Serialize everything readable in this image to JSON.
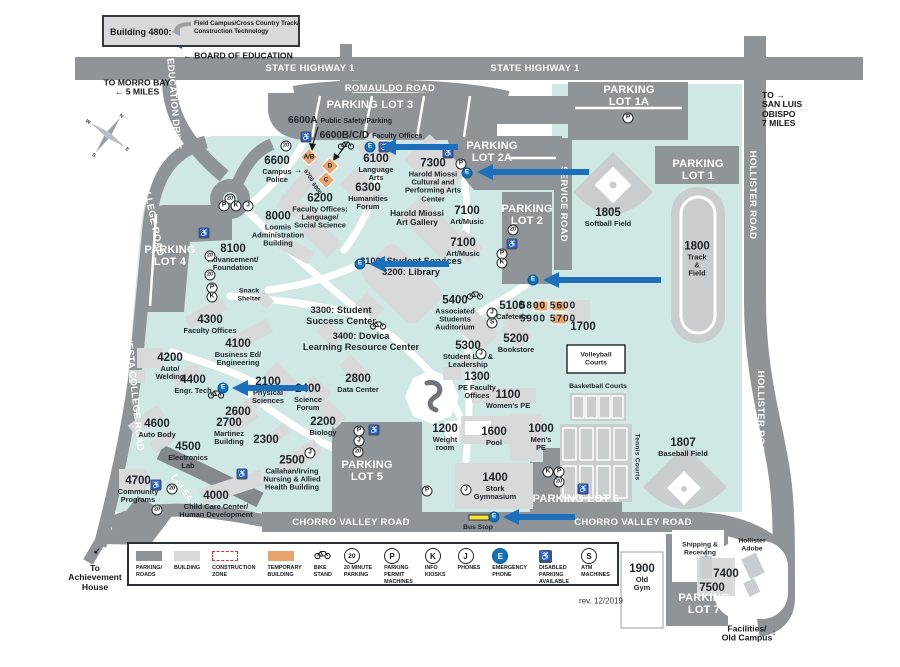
{
  "colors": {
    "campus": "#cfe8e5",
    "road": "#8f9499",
    "building": "#d7d9da",
    "field": "#c9cdd0",
    "temporary": "#e9a46c",
    "emergency_blue": "#1273bc",
    "arrow_blue": "#1b6fbd",
    "construction_red": "#e02f22",
    "bus_stop_yellow": "#f3e13c",
    "text_dark": "#15181c",
    "text_white": "#ffffff"
  },
  "callout": {
    "title": "Building 4800:",
    "text": "Field Campus/Cross Country Track/\nConstruction Technology"
  },
  "compass": [
    "N",
    "E",
    "S",
    "W"
  ],
  "road_labels": [
    {
      "t": "STATE HIGHWAY 1",
      "x": 310,
      "y": 69
    },
    {
      "t": "STATE HIGHWAY 1",
      "x": 535,
      "y": 69
    },
    {
      "t": "ROMAULDO ROAD",
      "x": 390,
      "y": 89
    },
    {
      "t": "CHORRO VALLEY ROAD",
      "x": 351,
      "y": 523
    },
    {
      "t": "CHORRO VALLEY ROAD",
      "x": 633,
      "y": 523
    },
    {
      "t": "EDUCATION DRIVE",
      "x": 173,
      "y": 104,
      "r": 85
    },
    {
      "t": "CUESTA COLLEGE ROAD",
      "x": 147,
      "y": 196,
      "r": 78
    },
    {
      "t": "CUESTA COLLEGE ROAD",
      "x": 133,
      "y": 390,
      "r": 84
    },
    {
      "t": "HOLLISTER ROAD",
      "x": 752,
      "y": 195,
      "r": 90
    },
    {
      "t": "HOLLISTER ROAD",
      "x": 760,
      "y": 415,
      "r": 90
    },
    {
      "t": "SERVICE ROAD",
      "x": 563,
      "y": 204,
      "r": 90
    },
    {
      "t": "Lot 5A",
      "x": 181,
      "y": 489,
      "r": 55
    },
    {
      "t": "Tennis Courts",
      "x": 637,
      "y": 457,
      "r": 90,
      "dark": true
    }
  ],
  "lot_labels": [
    {
      "t": "PARKING LOT 3",
      "x": 370,
      "y": 106
    },
    {
      "t": "PARKING\nLOT 1A",
      "x": 629,
      "y": 97
    },
    {
      "t": "PARKING\nLOT 2A",
      "x": 492,
      "y": 153
    },
    {
      "t": "PARKING\nLOT 1",
      "x": 698,
      "y": 171
    },
    {
      "t": "PARKING\nLOT 2",
      "x": 527,
      "y": 216
    },
    {
      "t": "PARKING\nLOT 4",
      "x": 170,
      "y": 257
    },
    {
      "t": "PARKING\nLOT 5",
      "x": 367,
      "y": 472
    },
    {
      "t": "PARKING LOT 6",
      "x": 576,
      "y": 500
    },
    {
      "t": "PARKING\nLOT 7",
      "x": 704,
      "y": 605
    }
  ],
  "buildings": [
    {
      "num": "6600A",
      "name": "Public Safety/Parking",
      "x": 340,
      "y": 119,
      "s": "inl"
    },
    {
      "num": "6600B/C/D",
      "name": "Faculty Offices",
      "x": 371,
      "y": 134,
      "s": "inl"
    },
    {
      "num": "6600",
      "name": "Campus\nPolice",
      "x": 277,
      "y": 170
    },
    {
      "num": "6100",
      "name": "Language\nArts",
      "x": 376,
      "y": 168
    },
    {
      "num": "7300",
      "name": "Harold Miossi\nCultural and\nPerforming Arts\nCenter",
      "x": 433,
      "y": 181
    },
    {
      "num": "6300",
      "name": "Humanities\nForum",
      "x": 368,
      "y": 197
    },
    {
      "num": "6200",
      "name": "Faculty Offices:\nLanguage/\nSocial Science",
      "x": 320,
      "y": 212
    },
    {
      "name": "Harold Miossi\nArt Gallery",
      "x": 417,
      "y": 218,
      "s": "md"
    },
    {
      "num": "7100",
      "name": "Art/Music",
      "x": 467,
      "y": 216
    },
    {
      "num": "7100",
      "name": "Art/Music",
      "x": 463,
      "y": 248
    },
    {
      "num": "8000",
      "name": "Loomis\nAdministration\nBuilding",
      "x": 278,
      "y": 230
    },
    {
      "num": "8100",
      "name": "Advancement/\nFoundation",
      "x": 233,
      "y": 258
    },
    {
      "name": "Snack\nShelter",
      "x": 249,
      "y": 295,
      "s": "sm"
    },
    {
      "name": "3100: Student Services\n3200: Library",
      "x": 411,
      "y": 267,
      "s": "lg"
    },
    {
      "name": "3300: Student\nSuccess Center",
      "x": 341,
      "y": 316,
      "s": "lg"
    },
    {
      "name": "3400: Dovica\nLearning Resource Center",
      "x": 361,
      "y": 342,
      "s": "lg"
    },
    {
      "num": "5400",
      "name": "Associated\nStudents\nAuditorium",
      "x": 455,
      "y": 314
    },
    {
      "num": "5100",
      "name": "Cafeteria",
      "x": 512,
      "y": 311
    },
    {
      "name": "5800 5600",
      "x": 548,
      "y": 306,
      "s": "num2"
    },
    {
      "name": "5900 5700",
      "x": 548,
      "y": 319,
      "s": "num2"
    },
    {
      "num": "1700",
      "x": 583,
      "y": 328
    },
    {
      "num": "5200",
      "name": "Bookstore",
      "x": 516,
      "y": 344
    },
    {
      "num": "5300",
      "name": "Student Life &\nLeadership",
      "x": 468,
      "y": 355
    },
    {
      "num": "4300",
      "name": "Faculty Offices",
      "x": 210,
      "y": 325
    },
    {
      "num": "4100",
      "name": "Business Ed/\nEngineering",
      "x": 238,
      "y": 353
    },
    {
      "num": "4200",
      "name": "Auto/\nWelding",
      "x": 170,
      "y": 367
    },
    {
      "num": "4400",
      "name": "Engr. Tech",
      "x": 193,
      "y": 385
    },
    {
      "num": "2100",
      "name": "Physical\nSciences",
      "x": 268,
      "y": 391
    },
    {
      "num": "2400",
      "name": "Science\nForum",
      "x": 308,
      "y": 398
    },
    {
      "num": "2800",
      "name": "Data Center",
      "x": 358,
      "y": 384
    },
    {
      "num": "2600",
      "x": 238,
      "y": 413
    },
    {
      "num": "2700",
      "name": "Martinez\nBuilding",
      "x": 229,
      "y": 432
    },
    {
      "num": "2300",
      "x": 266,
      "y": 441
    },
    {
      "num": "2200",
      "name": "Biology",
      "x": 323,
      "y": 427
    },
    {
      "num": "4600",
      "name": "Auto Body",
      "x": 157,
      "y": 429
    },
    {
      "num": "4500",
      "name": "Electronics\nLab",
      "x": 188,
      "y": 456
    },
    {
      "num": "2500",
      "name": "Callahan/Irving\nNursing & Allied\nHealth Building",
      "x": 292,
      "y": 474
    },
    {
      "num": "4700",
      "name": "Community\nPrograms",
      "x": 138,
      "y": 490
    },
    {
      "num": "4000",
      "name": "Child Care Center/\nHuman Development",
      "x": 216,
      "y": 505
    },
    {
      "num": "1300",
      "name": "PE Faculty\nOffices",
      "x": 477,
      "y": 386
    },
    {
      "num": "1100",
      "name": "Women's PE",
      "x": 508,
      "y": 400
    },
    {
      "num": "1200",
      "name": "Weight\nroom",
      "x": 445,
      "y": 438
    },
    {
      "num": "1600",
      "name": "Pool",
      "x": 494,
      "y": 437
    },
    {
      "num": "1000",
      "name": "Men's\nPE",
      "x": 541,
      "y": 438
    },
    {
      "num": "1400",
      "name": "Stork\nGymnasium",
      "x": 495,
      "y": 487
    },
    {
      "name": "Bus Stop",
      "x": 478,
      "y": 528,
      "s": "sm"
    },
    {
      "num": "1805",
      "name": "Softball Field",
      "x": 608,
      "y": 218
    },
    {
      "num": "1800",
      "name": "Track\n&\nField",
      "x": 697,
      "y": 260
    },
    {
      "name": "Volleyball\nCourts",
      "x": 596,
      "y": 359,
      "s": "sm"
    },
    {
      "name": "Basketball Courts",
      "x": 598,
      "y": 387,
      "s": "sm"
    },
    {
      "num": "1807",
      "name": "Baseball Field",
      "x": 683,
      "y": 448
    },
    {
      "num": "1900",
      "name": "Old\nGym",
      "x": 642,
      "y": 578
    },
    {
      "name": "Shipping &\nReceiving",
      "x": 700,
      "y": 549,
      "s": "sm"
    },
    {
      "name": "Hollister\nAdobe",
      "x": 752,
      "y": 545,
      "s": "sm"
    },
    {
      "num": "7400",
      "x": 726,
      "y": 575
    },
    {
      "num": "7500",
      "x": 712,
      "y": 589
    }
  ],
  "notes": [
    {
      "t": "← BOARD OF EDUCATION",
      "x": 238,
      "y": 56
    },
    {
      "t": "TO MORRO BAY\n← 5 MILES",
      "x": 137,
      "y": 88
    },
    {
      "t": "TO →\nSAN LUIS\nOBISPO\n7 MILES",
      "x": 762,
      "y": 110,
      "ta": "l"
    },
    {
      "t": "To\nAchievement\nHouse",
      "x": 95,
      "y": 578
    },
    {
      "t": "Facilities/\nOld Campus",
      "x": 747,
      "y": 634
    },
    {
      "t": "↓",
      "x": 774,
      "y": 633
    },
    {
      "t": "↙",
      "x": 97,
      "y": 551
    },
    {
      "t": "→",
      "x": 298,
      "y": 170
    },
    {
      "t": "6700",
      "x": 308,
      "y": 176,
      "r": 55,
      "s": "smn"
    },
    {
      "t": "6800",
      "x": 316,
      "y": 189,
      "r": 55,
      "s": "smn"
    },
    {
      "t": "rev. 12/2019",
      "x": 601,
      "y": 602,
      "s": "plain"
    }
  ],
  "temp_buildings": [
    {
      "t": "A/B",
      "x": 309,
      "y": 157,
      "d": 1
    },
    {
      "t": "D",
      "x": 330,
      "y": 166,
      "d": 1
    },
    {
      "t": "C",
      "x": 326,
      "y": 180,
      "d": 1
    },
    {
      "x": 541,
      "y": 306
    },
    {
      "x": 559,
      "y": 306
    },
    {
      "x": 559,
      "y": 319
    }
  ],
  "icons": [
    {
      "t": "E",
      "x": 156,
      "y": 41
    },
    {
      "t": "20",
      "x": 230,
      "y": 199
    },
    {
      "t": "20",
      "x": 286,
      "y": 146
    },
    {
      "t": "hc",
      "x": 306,
      "y": 137
    },
    {
      "t": "bike",
      "x": 346,
      "y": 145
    },
    {
      "t": "E",
      "x": 370,
      "y": 147
    },
    {
      "t": "hc",
      "x": 384,
      "y": 147
    },
    {
      "t": "hc",
      "x": 448,
      "y": 153
    },
    {
      "t": "P",
      "x": 461,
      "y": 164
    },
    {
      "t": "E",
      "x": 467,
      "y": 173
    },
    {
      "t": "P",
      "x": 628,
      "y": 118
    },
    {
      "t": "P",
      "x": 224,
      "y": 206
    },
    {
      "t": "K",
      "x": 236,
      "y": 206
    },
    {
      "t": "J",
      "x": 248,
      "y": 206
    },
    {
      "t": "hc",
      "x": 204,
      "y": 233
    },
    {
      "t": "20",
      "x": 210,
      "y": 256
    },
    {
      "t": "20",
      "x": 210,
      "y": 275
    },
    {
      "t": "P",
      "x": 212,
      "y": 288
    },
    {
      "t": "K",
      "x": 212,
      "y": 297
    },
    {
      "t": "20",
      "x": 513,
      "y": 230
    },
    {
      "t": "hc",
      "x": 512,
      "y": 244
    },
    {
      "t": "P",
      "x": 502,
      "y": 254
    },
    {
      "t": "K",
      "x": 502,
      "y": 263
    },
    {
      "t": "E",
      "x": 360,
      "y": 264
    },
    {
      "t": "E",
      "x": 533,
      "y": 280
    },
    {
      "t": "bike",
      "x": 475,
      "y": 295
    },
    {
      "t": "bike",
      "x": 378,
      "y": 325
    },
    {
      "t": "J",
      "x": 492,
      "y": 313
    },
    {
      "t": "S",
      "x": 492,
      "y": 323
    },
    {
      "t": "J",
      "x": 481,
      "y": 354
    },
    {
      "t": "bike",
      "x": 216,
      "y": 394
    },
    {
      "t": "E",
      "x": 223,
      "y": 388
    },
    {
      "t": "P",
      "x": 359,
      "y": 431
    },
    {
      "t": "J",
      "x": 359,
      "y": 441
    },
    {
      "t": "20",
      "x": 358,
      "y": 452
    },
    {
      "t": "hc",
      "x": 374,
      "y": 430
    },
    {
      "t": "J",
      "x": 310,
      "y": 453
    },
    {
      "t": "hc",
      "x": 242,
      "y": 474
    },
    {
      "t": "hc",
      "x": 156,
      "y": 485
    },
    {
      "t": "20",
      "x": 172,
      "y": 489
    },
    {
      "t": "20",
      "x": 157,
      "y": 510
    },
    {
      "t": "P",
      "x": 427,
      "y": 491
    },
    {
      "t": "J",
      "x": 466,
      "y": 490
    },
    {
      "t": "K",
      "x": 548,
      "y": 472
    },
    {
      "t": "P",
      "x": 559,
      "y": 472
    },
    {
      "t": "20",
      "x": 559,
      "y": 482
    },
    {
      "t": "hc",
      "x": 583,
      "y": 489
    },
    {
      "t": "E",
      "x": 494,
      "y": 517
    }
  ],
  "arrows": [
    {
      "x": 166,
      "y": 41,
      "l": 82
    },
    {
      "x": 380,
      "y": 147,
      "l": 78
    },
    {
      "x": 477,
      "y": 172,
      "l": 112
    },
    {
      "x": 369,
      "y": 264,
      "l": 80
    },
    {
      "x": 543,
      "y": 280,
      "l": 118
    },
    {
      "x": 232,
      "y": 388,
      "l": 76
    },
    {
      "x": 503,
      "y": 517,
      "l": 72
    }
  ],
  "legend": {
    "items": [
      {
        "icon": "swatch-road",
        "label": "PARKING/\nROADS"
      },
      {
        "icon": "swatch-bld",
        "label": "BUILDING"
      },
      {
        "icon": "swatch-con",
        "label": "CONSTRUCTION\nZONE"
      },
      {
        "icon": "swatch-tmp",
        "label": "TEMPORARY\nBUILDING"
      },
      {
        "icon": "bike",
        "label": "BIKE\nSTAND"
      },
      {
        "icon": "20",
        "label": "20 MINUTE\nPARKING"
      },
      {
        "icon": "P",
        "label": "PARKING\nPERMIT\nMACHINES"
      },
      {
        "icon": "K",
        "label": "INFO\nKIOSKS"
      },
      {
        "icon": "J",
        "label": "PHONES"
      },
      {
        "icon": "E",
        "label": "EMERGENCY\nPHONE"
      },
      {
        "icon": "hc",
        "label": "DISABLED\nPARKING\nAVAILABLE"
      },
      {
        "icon": "S",
        "label": "ATM\nMACHINES"
      }
    ]
  }
}
